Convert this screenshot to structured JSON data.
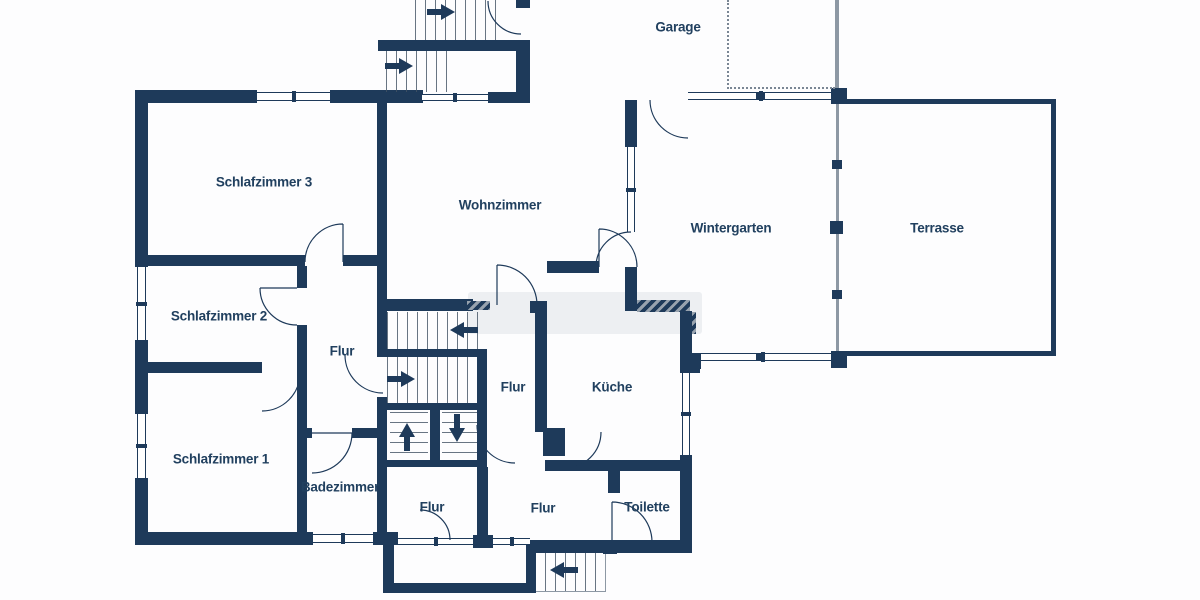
{
  "plan": {
    "type": "floor-plan",
    "rooms": [
      {
        "id": "garage",
        "label": "Garage"
      },
      {
        "id": "schlafzimmer-3",
        "label": "Schlafzimmer 3"
      },
      {
        "id": "wohnzimmer",
        "label": "Wohnzimmer"
      },
      {
        "id": "wintergarten",
        "label": "Wintergarten"
      },
      {
        "id": "terrasse",
        "label": "Terrasse"
      },
      {
        "id": "schlafzimmer-2",
        "label": "Schlafzimmer 2"
      },
      {
        "id": "flur-mitte",
        "label": "Flur"
      },
      {
        "id": "flur-treppe",
        "label": "Flur"
      },
      {
        "id": "kueche",
        "label": "Küche"
      },
      {
        "id": "schlafzimmer-1",
        "label": "Schlafzimmer 1"
      },
      {
        "id": "badezimmer",
        "label": "Badezimmer"
      },
      {
        "id": "flur-sued-west",
        "label": "Flur"
      },
      {
        "id": "flur-sued-ost",
        "label": "Flur"
      },
      {
        "id": "toilette",
        "label": "Toilette"
      }
    ],
    "stair_arrows": [
      "right",
      "right",
      "left",
      "right",
      "up",
      "down",
      "left"
    ],
    "colors": {
      "wall": "#1e3a5a",
      "background": "#ffffff",
      "stair_tread": "#435364",
      "boundary_line": "#8d98a4",
      "hatch": "#97a2ae",
      "watermark": "#a8b2be"
    }
  }
}
